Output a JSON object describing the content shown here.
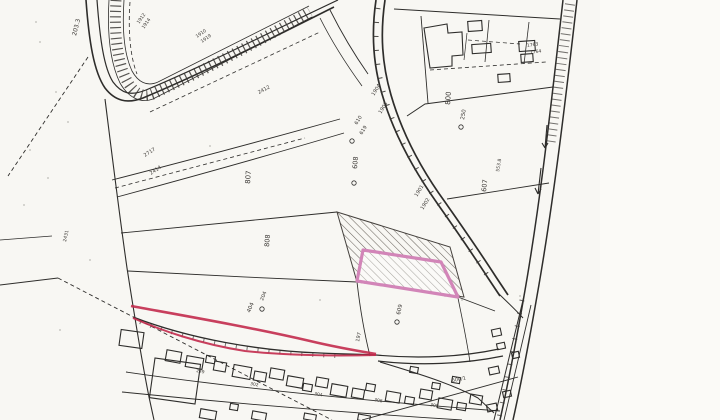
{
  "meta": {
    "title": "Scanned cadastral survey map with highlighted parcel",
    "ink": "#2e2d2b",
    "red_accent": "#c22a4c",
    "pink_accent": "#d285b8",
    "paper": "#f8f7f3"
  },
  "map": {
    "roads": [
      {
        "d": "M 86,0 C 89,42 94,72 105,88 C 115,101 127,104 143,98 C 205,72 268,40 334,7",
        "w": 1.6
      },
      {
        "d": "M 97,0 C 100,40 104,68 113,82 C 122,94 131,96 146,90 C 208,64 270,32 338,0",
        "w": 1.2
      },
      {
        "d": "M 330,10 C 342,34 354,54 368,74",
        "w": 0.9
      },
      {
        "d": "M 320,18 C 332,42 346,64 362,86",
        "w": 0.8
      },
      {
        "d": "M 376,0 C 371,34 373,64 382,94 C 393,132 413,169 437,203 C 453,226 470,250 488,278 L 500,296",
        "w": 1.7
      },
      {
        "d": "M 385,0 C 380,34 382,64 391,95 C 402,133 421,169 445,202 C 461,225 478,249 496,277 L 508,295",
        "w": 1.7
      },
      {
        "d": "M 563,0 C 552,96 541,200 524,296 C 516,342 508,384 500,420",
        "w": 1.5
      },
      {
        "d": "M 577,0 C 566,96 554,200 537,296 C 529,342 521,384 513,420",
        "w": 1.5
      },
      {
        "d": "M 524,296 L 494,420",
        "w": 1.0
      },
      {
        "d": "M 531,305 L 504,420",
        "w": 0.9
      },
      {
        "d": "M 497,292 C 505,300 514,308 523,318",
        "w": 1.0
      },
      {
        "d": "M 105,99 C 112,155 119,212 127,268 C 133,306 140,352 149,397 L 154,420",
        "w": 1.1
      },
      {
        "d": "M 112,180 C 190,160 265,140 340,119",
        "w": 0.9
      },
      {
        "d": "M 117,197 C 195,176 270,155 344,133",
        "w": 0.9
      },
      {
        "d": "M 121,233 C 195,226 265,219 337,212",
        "w": 0.9
      },
      {
        "d": "M 128,271 C 205,275 280,279 357,282",
        "w": 0.9
      },
      {
        "d": "M 133,317 C 190,339 260,351 320,353 C 340,354 360,354 376,355",
        "w": 1.3
      },
      {
        "d": "M 376,355 C 418,359 462,357 499,349",
        "w": 1.2
      },
      {
        "d": "M 378,361 C 420,366 464,364 503,356",
        "w": 1.2
      },
      {
        "d": "M 380,362 C 420,374 452,384 478,398 L 494,413",
        "w": 1.0
      },
      {
        "d": "M 126,372 C 250,390 380,402 500,411",
        "w": 0.9
      },
      {
        "d": "M 122,392 C 240,404 350,413 462,420",
        "w": 0.9
      },
      {
        "d": "M 362,420 L 518,377",
        "w": 0.9
      },
      {
        "d": "M 447,199 L 549,183",
        "w": 0.9
      },
      {
        "d": "M 394,9 L 560,19",
        "w": 1.0
      },
      {
        "d": "M 407,116 L 425,104 L 553,87",
        "w": 1.0
      },
      {
        "d": "M 421,16 L 428,103",
        "w": 0.9
      },
      {
        "d": "M 489,20 L 485,62",
        "w": 0.8
      },
      {
        "d": "M 529,22 L 524,64",
        "w": 0.8
      },
      {
        "d": "M 467,33 L 464,60",
        "w": 0.7
      },
      {
        "d": "M 458,297 L 495,311",
        "w": 0.9
      },
      {
        "d": "M 357,282 C 360,308 364,332 370,356",
        "w": 0.9
      },
      {
        "d": "M 458,298 C 462,318 466,336 470,362",
        "w": 0.8
      },
      {
        "d": "M 0,285 L 58,278",
        "w": 0.9
      },
      {
        "d": "M 0,240 L 52,236",
        "w": 0.8
      },
      {
        "d": "M 109,0 C 107,34 110,62 120,83 C 128,97 140,104 153,99 L 312,17",
        "w": 0.8
      },
      {
        "d": "M 124,0 C 122,30 124,54 132,71 C 138,82 147,87 158,82 L 309,6",
        "w": 0.8
      }
    ],
    "dashed": [
      {
        "d": "M 115,188 L 305,138",
        "w": 0.8
      },
      {
        "d": "M 88,57 L 8,176",
        "w": 0.9
      },
      {
        "d": "M 58,278 L 332,420",
        "w": 0.9
      },
      {
        "d": "M 430,70 L 546,62",
        "w": 0.8
      },
      {
        "d": "M 468,40 L 520,44",
        "w": 0.7
      },
      {
        "d": "M 130,2 C 128,30 130,56 137,74",
        "w": 0.8
      },
      {
        "d": "M 150,112 L 320,32",
        "w": 0.8
      }
    ],
    "ticks": [
      {
        "d": "M 116,0 C 114,32 117,60 126,79 C 133,93 143,99 155,93 C 213,66 268,36 310,12",
        "w": 11,
        "dash": "1.2 4.2",
        "o": 0.85
      },
      {
        "d": "M 570,4 C 561,66 555,112 550,146",
        "w": 10,
        "dash": "1 5",
        "o": 0.7
      },
      {
        "d": "M 378,8 C 374,38 376,66 384,95 C 395,132 414,168 438,202 C 453,225 470,248 487,275",
        "w": 5,
        "dash": "1 13",
        "o": 0.9
      },
      {
        "d": "M 522,300 C 514,344 506,386 499,418",
        "w": 5,
        "dash": "1 12",
        "o": 0.8
      },
      {
        "d": "M 140,322 C 200,344 270,354 340,356",
        "w": 4,
        "dash": "1 10",
        "o": 0.7
      }
    ],
    "hatch_parcel": {
      "points": "337,212 450,247 464,297 357,282"
    },
    "pink_parcel": {
      "points": "363,250 441,262 458,297 357,281"
    },
    "red_lines": [
      {
        "d": "M 131,306 C 180,315 250,327 310,341 C 335,347 358,351 376,354",
        "w": 2.6
      },
      {
        "d": "M 133,318 C 160,330 200,344 245,351 C 290,356 335,356 376,355",
        "w": 2.0
      }
    ],
    "building_paths": [
      {
        "d": "M 424,28 L 447,24 L 448,33 L 462,32 L 463,55 L 452,56 L 452,66 L 430,68 Z"
      },
      {
        "d": "M 541,168 L 538,194 M 538,194 L 535,188 M 538,194 L 541,189"
      },
      {
        "d": "M 547,125 L 545,148 M 545,148 L 542,143 M 545,148 L 548,143"
      }
    ],
    "buildings": [
      {
        "x": 468,
        "y": 21,
        "w": 14,
        "h": 10,
        "r": -4
      },
      {
        "x": 472,
        "y": 44,
        "w": 19,
        "h": 9,
        "r": -4
      },
      {
        "x": 519,
        "y": 41,
        "w": 16,
        "h": 10,
        "r": -4
      },
      {
        "x": 521,
        "y": 54,
        "w": 12,
        "h": 8,
        "r": -4
      },
      {
        "x": 498,
        "y": 74,
        "w": 12,
        "h": 8,
        "r": -4
      },
      {
        "x": 120,
        "y": 331,
        "w": 23,
        "h": 16,
        "r": 8
      },
      {
        "x": 152,
        "y": 361,
        "w": 46,
        "h": 40,
        "r": 8
      },
      {
        "x": 166,
        "y": 351,
        "w": 15,
        "h": 11,
        "r": 10
      },
      {
        "x": 186,
        "y": 357,
        "w": 17,
        "h": 11,
        "r": 10
      },
      {
        "x": 206,
        "y": 356,
        "w": 9,
        "h": 7,
        "r": 10
      },
      {
        "x": 214,
        "y": 362,
        "w": 12,
        "h": 9,
        "r": 10
      },
      {
        "x": 233,
        "y": 366,
        "w": 18,
        "h": 12,
        "r": 10
      },
      {
        "x": 254,
        "y": 372,
        "w": 12,
        "h": 9,
        "r": 10
      },
      {
        "x": 270,
        "y": 369,
        "w": 14,
        "h": 10,
        "r": 10
      },
      {
        "x": 287,
        "y": 377,
        "w": 16,
        "h": 10,
        "r": 10
      },
      {
        "x": 303,
        "y": 384,
        "w": 9,
        "h": 7,
        "r": 10
      },
      {
        "x": 316,
        "y": 378,
        "w": 12,
        "h": 9,
        "r": 10
      },
      {
        "x": 331,
        "y": 385,
        "w": 16,
        "h": 11,
        "r": 10
      },
      {
        "x": 352,
        "y": 389,
        "w": 12,
        "h": 9,
        "r": 10
      },
      {
        "x": 366,
        "y": 384,
        "w": 9,
        "h": 7,
        "r": 10
      },
      {
        "x": 386,
        "y": 392,
        "w": 14,
        "h": 10,
        "r": 10
      },
      {
        "x": 405,
        "y": 397,
        "w": 9,
        "h": 7,
        "r": 10
      },
      {
        "x": 420,
        "y": 390,
        "w": 12,
        "h": 9,
        "r": 10
      },
      {
        "x": 438,
        "y": 399,
        "w": 14,
        "h": 10,
        "r": 10
      },
      {
        "x": 457,
        "y": 403,
        "w": 9,
        "h": 7,
        "r": 10
      },
      {
        "x": 470,
        "y": 395,
        "w": 12,
        "h": 9,
        "r": 10
      },
      {
        "x": 452,
        "y": 377,
        "w": 8,
        "h": 6,
        "r": 10
      },
      {
        "x": 410,
        "y": 367,
        "w": 8,
        "h": 6,
        "r": 10
      },
      {
        "x": 432,
        "y": 383,
        "w": 8,
        "h": 6,
        "r": 10
      },
      {
        "x": 200,
        "y": 410,
        "w": 16,
        "h": 9,
        "r": 10
      },
      {
        "x": 252,
        "y": 412,
        "w": 14,
        "h": 8,
        "r": 10
      },
      {
        "x": 304,
        "y": 414,
        "w": 12,
        "h": 6,
        "r": 10
      },
      {
        "x": 358,
        "y": 415,
        "w": 12,
        "h": 6,
        "r": 10
      },
      {
        "x": 230,
        "y": 404,
        "w": 8,
        "h": 6,
        "r": 10
      },
      {
        "x": 492,
        "y": 329,
        "w": 9,
        "h": 7,
        "r": -12
      },
      {
        "x": 497,
        "y": 343,
        "w": 8,
        "h": 6,
        "r": -12
      },
      {
        "x": 489,
        "y": 367,
        "w": 10,
        "h": 7,
        "r": -12
      },
      {
        "x": 503,
        "y": 391,
        "w": 8,
        "h": 6,
        "r": -12
      },
      {
        "x": 487,
        "y": 404,
        "w": 10,
        "h": 7,
        "r": -12
      },
      {
        "x": 512,
        "y": 352,
        "w": 7,
        "h": 6,
        "r": -12
      }
    ],
    "labels": [
      {
        "t": "203.3",
        "x": 76,
        "y": 36,
        "r": -76,
        "s": 6
      },
      {
        "t": "1912",
        "x": 139,
        "y": 24,
        "r": -55,
        "s": 4.6
      },
      {
        "t": "1914",
        "x": 144,
        "y": 29,
        "r": -55,
        "s": 4.6
      },
      {
        "t": "1910",
        "x": 197,
        "y": 38,
        "r": -35,
        "s": 4.6
      },
      {
        "t": "1919",
        "x": 202,
        "y": 43,
        "r": -35,
        "s": 4.6
      },
      {
        "t": "2412",
        "x": 259,
        "y": 94,
        "r": -28,
        "s": 5
      },
      {
        "t": "2717",
        "x": 145,
        "y": 157,
        "r": -33,
        "s": 5
      },
      {
        "t": "2414",
        "x": 151,
        "y": 175,
        "r": -33,
        "s": 5
      },
      {
        "t": "807",
        "x": 250,
        "y": 184,
        "r": -86,
        "s": 7
      },
      {
        "t": "808",
        "x": 269,
        "y": 247,
        "r": -86,
        "s": 6.5
      },
      {
        "t": "608",
        "x": 357,
        "y": 169,
        "r": -86,
        "s": 6.5
      },
      {
        "t": "800",
        "x": 450,
        "y": 105,
        "r": -86,
        "s": 7
      },
      {
        "t": "250",
        "x": 464,
        "y": 120,
        "r": -80,
        "s": 5.5
      },
      {
        "t": "607",
        "x": 486,
        "y": 192,
        "r": -84,
        "s": 6.5
      },
      {
        "t": "553.8",
        "x": 499,
        "y": 172,
        "r": -80,
        "s": 4.6
      },
      {
        "t": "1904",
        "x": 374,
        "y": 96,
        "r": -58,
        "s": 5
      },
      {
        "t": "1903",
        "x": 381,
        "y": 114,
        "r": -58,
        "s": 5
      },
      {
        "t": "1901",
        "x": 417,
        "y": 197,
        "r": -58,
        "s": 5
      },
      {
        "t": "1902",
        "x": 423,
        "y": 210,
        "r": -58,
        "s": 5
      },
      {
        "t": "610",
        "x": 357,
        "y": 125,
        "r": -58,
        "s": 5
      },
      {
        "t": "619",
        "x": 362,
        "y": 135,
        "r": -58,
        "s": 5
      },
      {
        "t": "404",
        "x": 250,
        "y": 313,
        "r": -68,
        "s": 5.5
      },
      {
        "t": "204",
        "x": 263,
        "y": 301,
        "r": -68,
        "s": 5
      },
      {
        "t": "197",
        "x": 359,
        "y": 342,
        "r": -78,
        "s": 5
      },
      {
        "t": "609",
        "x": 400,
        "y": 315,
        "r": -78,
        "s": 5.5
      },
      {
        "t": "600/1",
        "x": 452,
        "y": 382,
        "r": -10,
        "s": 5
      },
      {
        "t": "1763",
        "x": 527,
        "y": 47,
        "r": -8,
        "s": 4.6
      },
      {
        "t": "1764",
        "x": 530,
        "y": 54,
        "r": -8,
        "s": 4.6
      },
      {
        "t": "2431",
        "x": 66,
        "y": 242,
        "r": -78,
        "s": 4.6
      },
      {
        "t": "249",
        "x": 196,
        "y": 372,
        "r": 10,
        "s": 4.4
      },
      {
        "t": "302",
        "x": 250,
        "y": 385,
        "r": 10,
        "s": 4.4
      },
      {
        "t": "304",
        "x": 314,
        "y": 395,
        "r": 10,
        "s": 4.4
      },
      {
        "t": "306",
        "x": 374,
        "y": 401,
        "r": 10,
        "s": 4.4
      },
      {
        "t": "308",
        "x": 430,
        "y": 406,
        "r": 10,
        "s": 4.4
      }
    ],
    "circles": [
      {
        "x": 354,
        "y": 183
      },
      {
        "x": 461,
        "y": 127
      },
      {
        "x": 352,
        "y": 141
      },
      {
        "x": 397,
        "y": 322
      },
      {
        "x": 262,
        "y": 309
      }
    ],
    "dots": [
      [
        40,
        42
      ],
      [
        56,
        92
      ],
      [
        30,
        150
      ],
      [
        68,
        122
      ],
      [
        24,
        205
      ],
      [
        445,
        296
      ],
      [
        462,
        300
      ],
      [
        520,
        296
      ],
      [
        320,
        300
      ],
      [
        36,
        22
      ],
      [
        48,
        178
      ],
      [
        210,
        146
      ],
      [
        90,
        260
      ],
      [
        60,
        330
      ]
    ]
  }
}
